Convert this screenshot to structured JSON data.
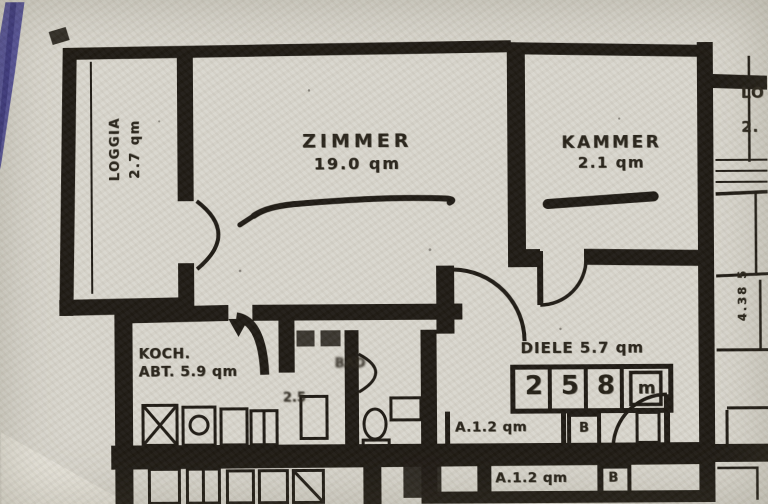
{
  "palette": {
    "paper": "#d8d5cc",
    "ink": "#1b1711",
    "pen_mark": "#3e3b8f"
  },
  "rooms": {
    "loggia": {
      "name": "LOGGIA",
      "area": "2.7 qm"
    },
    "zimmer": {
      "name": "ZIMMER",
      "area": "19.0 qm"
    },
    "kammer": {
      "name": "KAMMER",
      "area": "2.1 qm"
    },
    "koch": {
      "name": "KOCH.",
      "area": "ABT. 5.9 qm"
    },
    "bad": {
      "name": "BAD",
      "area": "2.5"
    },
    "diele": {
      "name": "DIELE 5.7 qm"
    },
    "neighbor": {
      "name": "LO",
      "area": "2."
    }
  },
  "closet": {
    "cells": [
      "2",
      "5",
      "8",
      "m"
    ]
  },
  "storage": {
    "row1": {
      "label": "A.1.2 qm",
      "tag": "B"
    },
    "row2": {
      "label": "A.1.2 qm",
      "tag": "B"
    }
  },
  "dimensions": {
    "right_vertical": "4.38 5"
  }
}
